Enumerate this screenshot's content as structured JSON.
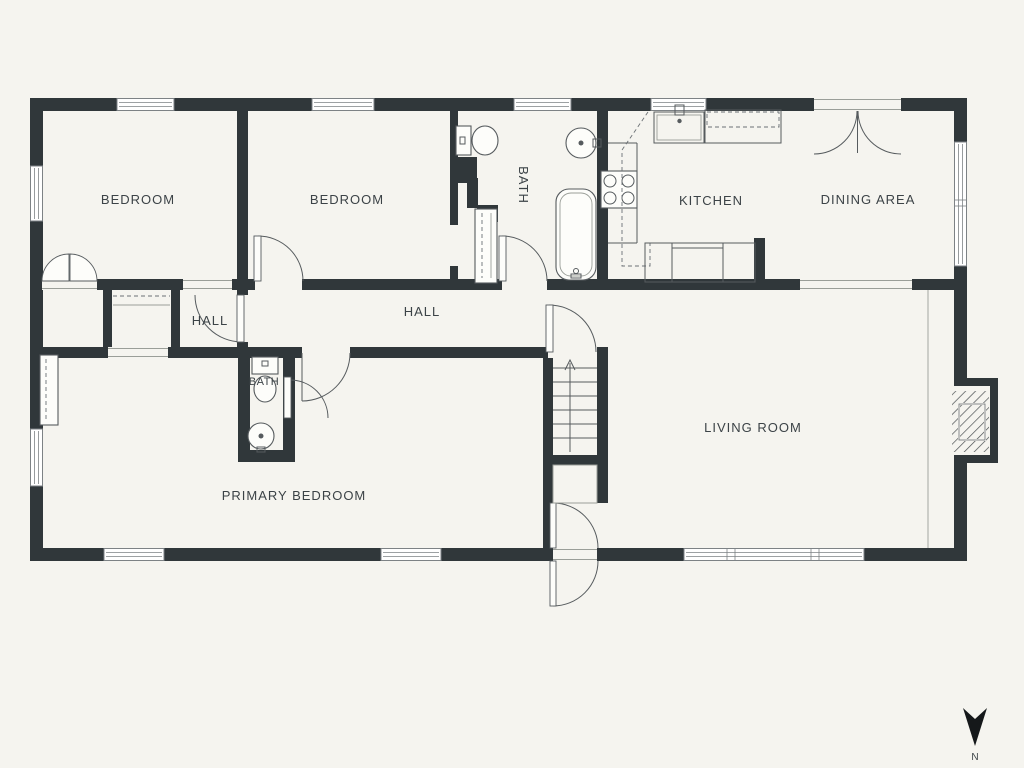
{
  "plan": {
    "type": "residential-floor-plan",
    "colors": {
      "background": "#f5f4ef",
      "wall": "#30373a",
      "label_text": "#3c4347",
      "fixture_line": "#565b5e"
    },
    "rooms": [
      {
        "id": "bedroom-1",
        "label": "BEDROOM"
      },
      {
        "id": "bedroom-2",
        "label": "BEDROOM"
      },
      {
        "id": "bath-1",
        "label": "BATH"
      },
      {
        "id": "kitchen",
        "label": "KITCHEN"
      },
      {
        "id": "dining-area",
        "label": "DINING AREA"
      },
      {
        "id": "hall-small",
        "label": "HALL"
      },
      {
        "id": "hall-main",
        "label": "HALL"
      },
      {
        "id": "bath-2",
        "label": "BATH"
      },
      {
        "id": "primary-bedroom",
        "label": "PRIMARY BEDROOM"
      },
      {
        "id": "living-room",
        "label": "LIVING ROOM"
      }
    ],
    "fixtures": [
      "toilet",
      "bathtub",
      "round-sink",
      "kitchen-sink",
      "stove-4-burner",
      "counters",
      "dishwasher",
      "stairs-up",
      "fireplace",
      "sliding-closet",
      "bifold-closet",
      "shelved-closet",
      "wardrobe",
      "french-doors"
    ],
    "compass": {
      "label": "N",
      "direction": "north-pointing-down"
    }
  }
}
